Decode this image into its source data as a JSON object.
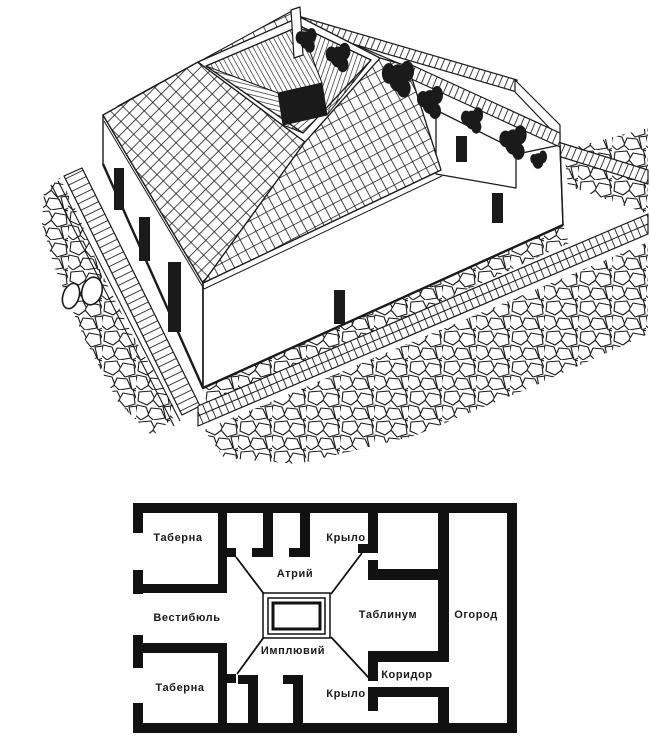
{
  "figure": {
    "background": "#ffffff",
    "ink": "#1a1a1a",
    "illustration_name": "roman-domus-axonometric-cutaway",
    "plan_name": "roman-domus-floor-plan"
  },
  "plan": {
    "rooms": [
      {
        "id": "taberna-top",
        "label": "Таберна"
      },
      {
        "id": "ala-top",
        "label": "Крыло"
      },
      {
        "id": "atrium",
        "label": "Атрий"
      },
      {
        "id": "vestibule",
        "label": "Вестибюль"
      },
      {
        "id": "tablinum",
        "label": "Таблинум"
      },
      {
        "id": "garden",
        "label": "Огород"
      },
      {
        "id": "impluvium",
        "label": "Имплювий"
      },
      {
        "id": "corridor",
        "label": "Коридор"
      },
      {
        "id": "taberna-bottom",
        "label": "Таберна"
      },
      {
        "id": "ala-bottom",
        "label": "Крыло"
      }
    ]
  }
}
